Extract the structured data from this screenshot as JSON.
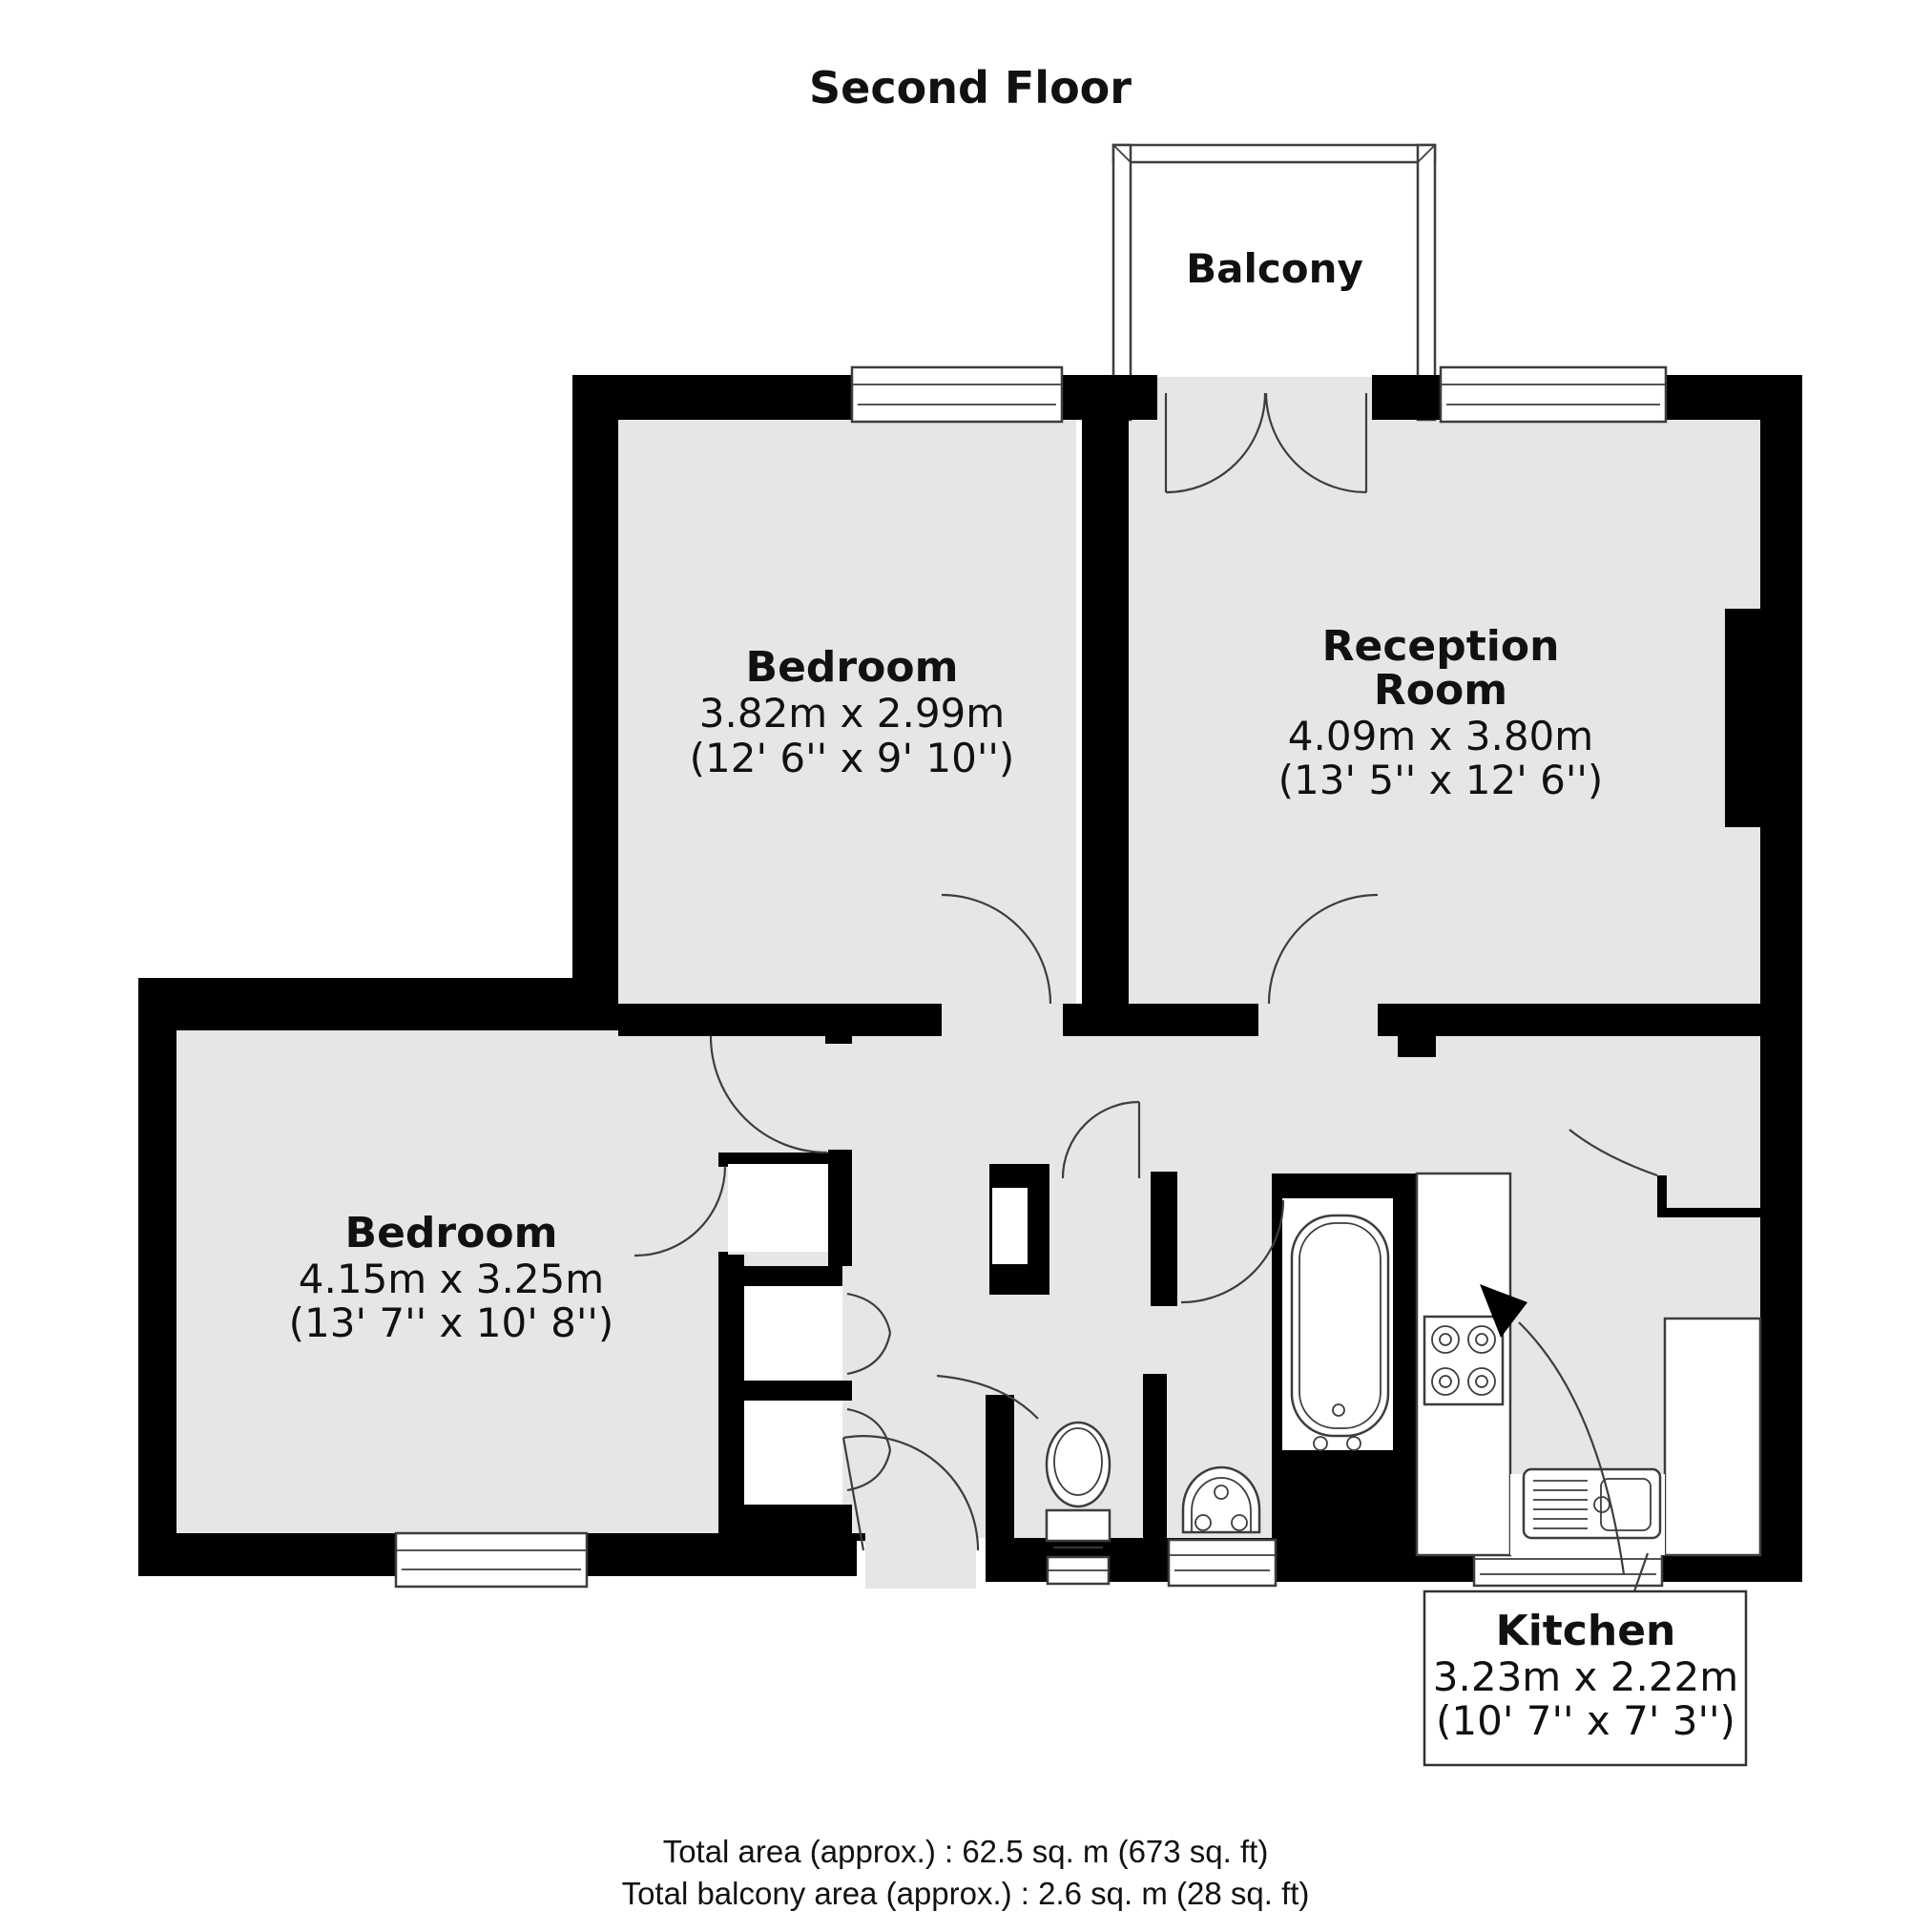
{
  "title": "Second Floor",
  "rooms": {
    "balcony": {
      "name": "Balcony"
    },
    "bedroom_top": {
      "name": "Bedroom",
      "size_metric": "3.82m x 2.99m",
      "size_imperial": "(12' 6'' x 9' 10'')"
    },
    "reception": {
      "name_line1": "Reception",
      "name_line2": "Room",
      "size_metric": "4.09m x 3.80m",
      "size_imperial": "(13' 5'' x 12' 6'')"
    },
    "bedroom_bottom": {
      "name": "Bedroom",
      "size_metric": "4.15m x 3.25m",
      "size_imperial": "(13' 7'' x 10' 8'')"
    },
    "kitchen": {
      "name": "Kitchen",
      "size_metric": "3.23m x 2.22m",
      "size_imperial": "(10' 7'' x 7' 3'')"
    }
  },
  "totals": {
    "total_area": "Total area (approx.) : 62.5 sq. m (673 sq. ft)",
    "total_balcony_area": "Total balcony area (approx.) : 2.6 sq. m (28 sq. ft)"
  },
  "fixtures": [
    "bathtub",
    "toilet",
    "wash-basin",
    "hob",
    "kitchen-sink",
    "kitchen-counter"
  ],
  "colors": {
    "wall": "#000000",
    "floor": "#e6e6e6",
    "outline": "#3d3d3d",
    "background": "#ffffff",
    "text": "#111111"
  }
}
